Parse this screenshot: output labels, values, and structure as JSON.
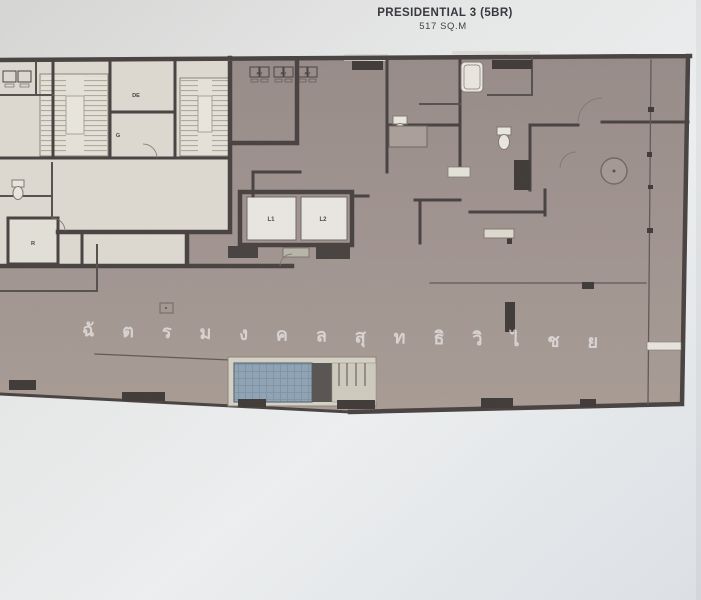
{
  "page": {
    "title": "PRESIDENTIAL 3 (5BR)",
    "subtitle": "517 SQ.M"
  },
  "plan": {
    "labels": {
      "lift_1": "L1",
      "lift_2": "L2",
      "room_de": "DE",
      "room_g": "G",
      "room_r": "R",
      "ac_unit": "AD"
    },
    "watermark": "ฉัตรมงคล สุทธิวิไชย",
    "watermark_spaced": "ฉั ต ร ม ง ค ล  สุ ท ธิ วิ ไ ช ย",
    "colors": {
      "paper": "#e0e3e6",
      "unit_fill": "#9f9290",
      "core_fill": "#ddd9d0",
      "wall": "#474140",
      "pool_water": "#8fa3b4",
      "deck": "#d6d1c5",
      "watermark": "#ffffff"
    }
  }
}
